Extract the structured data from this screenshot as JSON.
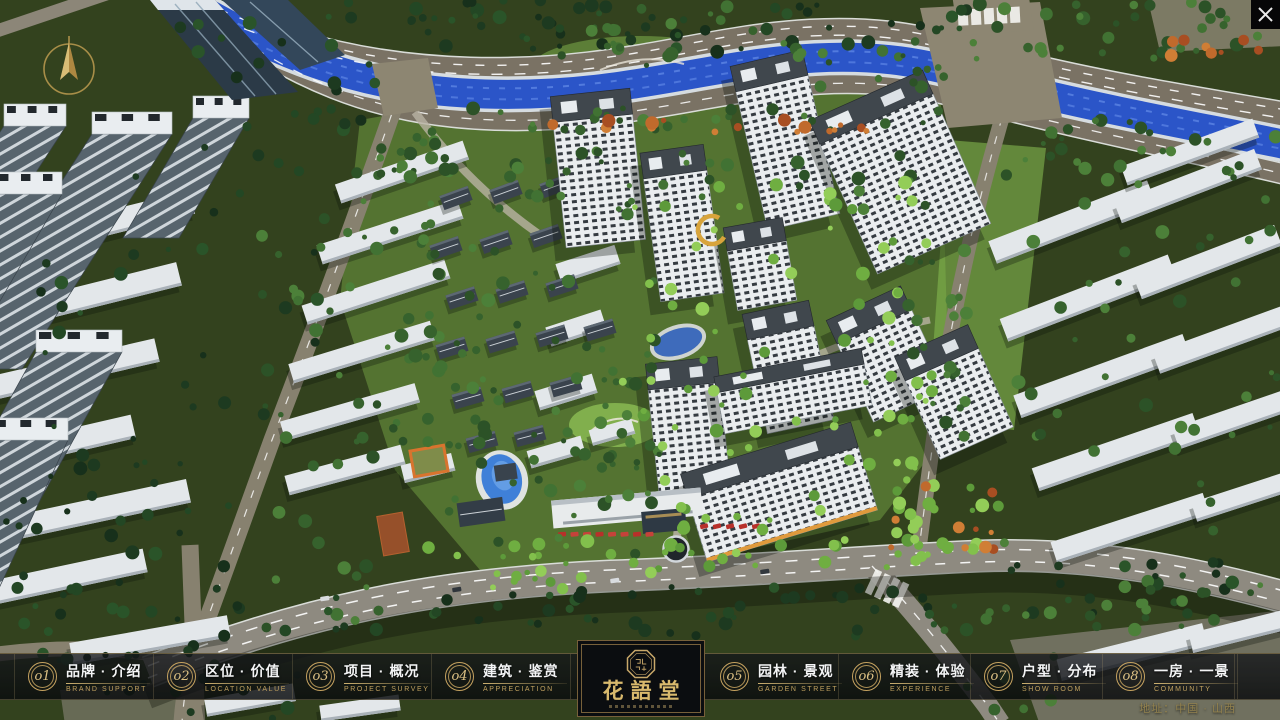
{
  "nav": {
    "items": [
      {
        "num": "o1",
        "zh": "品牌 · 介绍",
        "en": "BRAND SUPPORT"
      },
      {
        "num": "o2",
        "zh": "区位 · 价值",
        "en": "LOCATION VALUE"
      },
      {
        "num": "o3",
        "zh": "项目 · 概况",
        "en": "PROJECT SURVEY"
      },
      {
        "num": "o4",
        "zh": "建筑 · 鉴赏",
        "en": "APPRECIATION"
      },
      {
        "num": "o5",
        "zh": "园林 · 景观",
        "en": "GARDEN STREET"
      },
      {
        "num": "o6",
        "zh": "精装 · 体验",
        "en": "EXPERIENCE"
      },
      {
        "num": "o7",
        "zh": "户型 · 分布",
        "en": "SHOW ROOM"
      },
      {
        "num": "o8",
        "zh": "一房 · 一景",
        "en": "COMMUNITY"
      }
    ],
    "logo": {
      "title": "花語堂"
    },
    "address": "地址：中国 · 山西"
  },
  "theme": {
    "gold": "#c6a360",
    "bar_bg": "rgba(12,14,16,0.8)",
    "river_blue": "#2b55c8",
    "lawn_green": "#7cb049"
  }
}
